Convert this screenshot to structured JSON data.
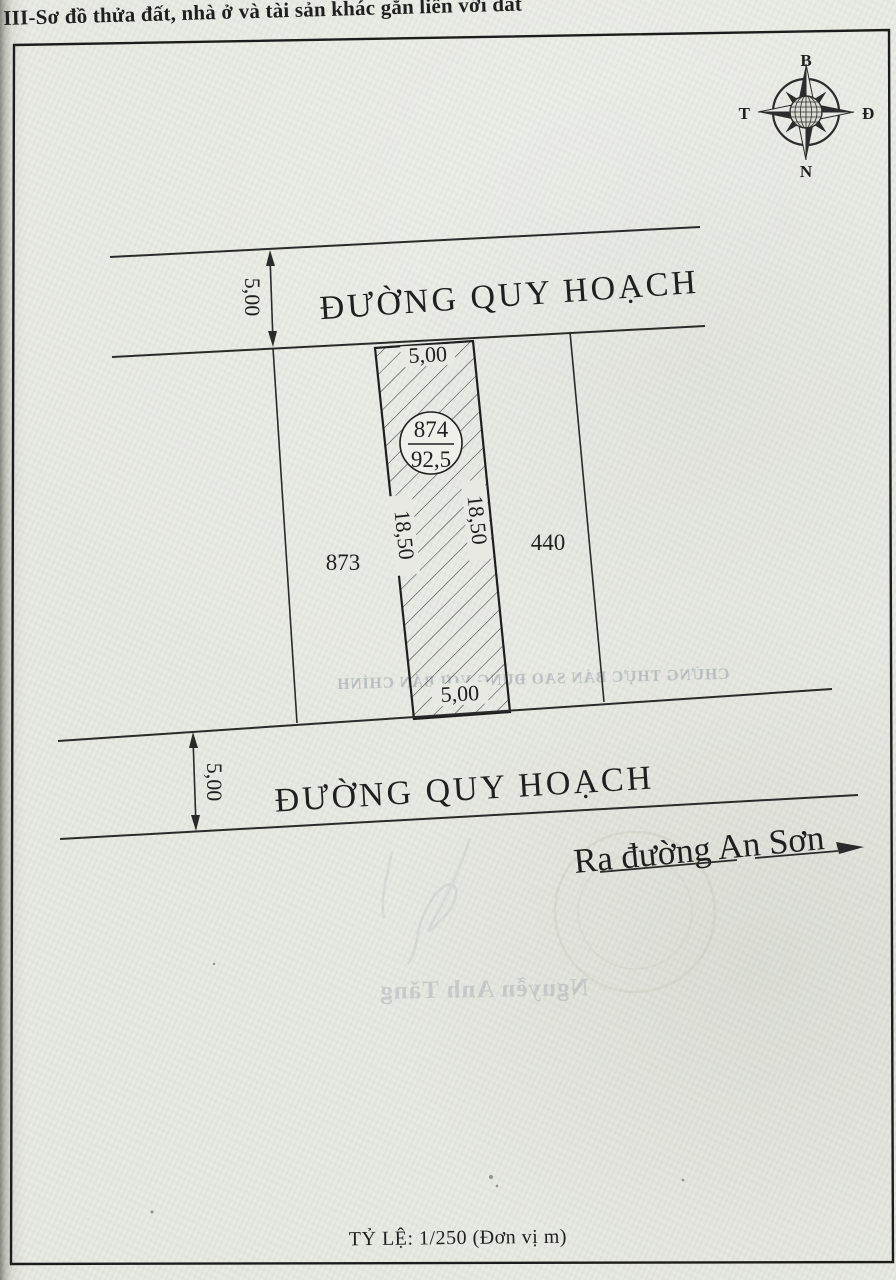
{
  "document": {
    "section_title": "III-Sơ đồ thửa đất, nhà ở và tài sản khác gắn liền với đất",
    "scale_note": "TỶ LỆ: 1/250 (Đơn vị m)"
  },
  "compass": {
    "north_label": "B",
    "east_label": "Đ",
    "south_label": "N",
    "west_label": "T"
  },
  "diagram": {
    "top_road": {
      "name": "ĐƯỜNG QUY HOẠCH",
      "width": "5,00"
    },
    "bottom_road": {
      "name": "ĐƯỜNG QUY HOẠCH",
      "width": "5,00"
    },
    "exit_direction": "Ra đường An Sơn",
    "parcel": {
      "number": "874",
      "area": "92,5",
      "front_width": "5,00",
      "back_width": "5,00",
      "left_length": "18,50",
      "right_length": "18,50"
    },
    "neighbor_parcels": {
      "left": "873",
      "right": "440"
    }
  },
  "bleed_through": {
    "certify_line": "CHỨNG THỰC BẢN SAO ĐÚNG VỚI BẢN CHÍNH",
    "signature_name": "Nguyễn Anh Tăng"
  },
  "colors": {
    "paper": "#e7e9e2",
    "ink": "#1f1f1f",
    "ghost_ink": "#8a929d"
  }
}
